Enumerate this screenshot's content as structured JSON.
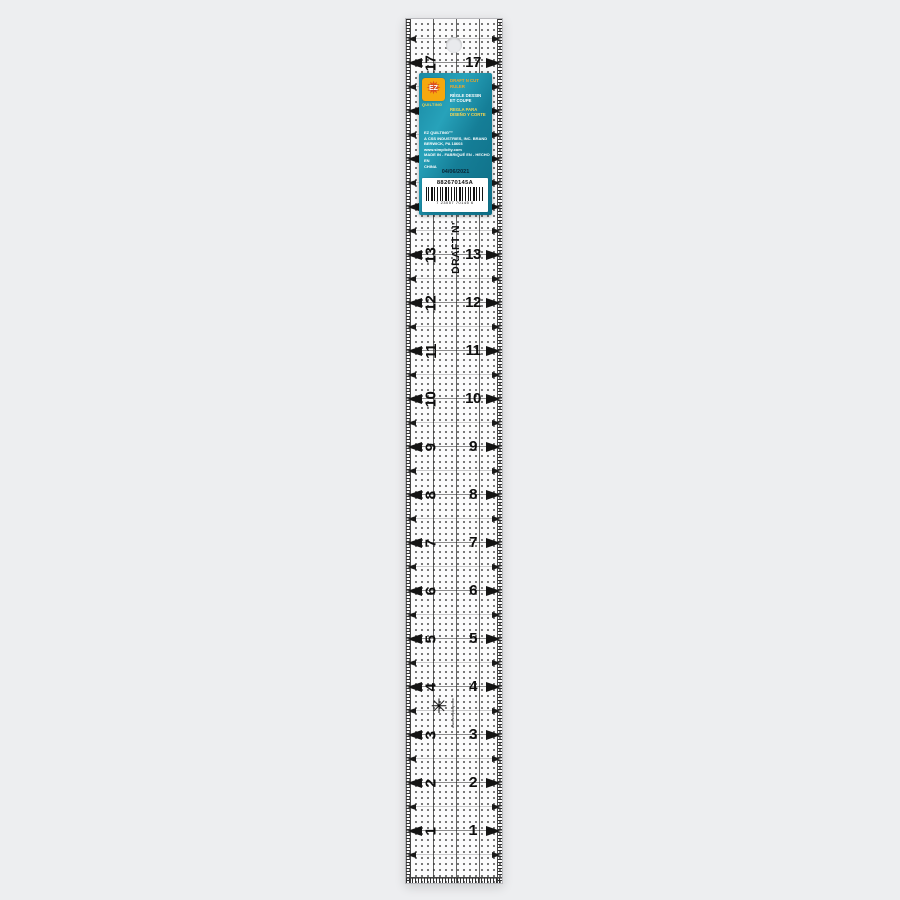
{
  "page": {
    "background_color": "#edeef0"
  },
  "ruler": {
    "inch_numbers": [
      "17",
      "16",
      "15",
      "14",
      "13",
      "12",
      "11",
      "10",
      "9",
      "8",
      "7",
      "6",
      "5",
      "4",
      "3",
      "2",
      "1"
    ],
    "brand_text": "DRAFT N'",
    "center_star_icon": "✳",
    "website_vertical_text": "www.simplicity.com",
    "mark_color": "#141414"
  },
  "tag": {
    "logo_star_icon": "✹",
    "logo_monogram": "EZ",
    "brand_name": "QUILTING",
    "title_en": "DRAFT N CUT RULER",
    "title_fr_line1": "RÈGLE DESSIN",
    "title_fr_line2": "ET COUPE",
    "title_es_line1": "REGLA PARA",
    "title_es_line2": "DISEÑO Y CORTE",
    "company_line1": "EZ QUILTING™",
    "company_line2": "A CSS INDUSTRIES, INC. BRAND",
    "company_line3": "BERWICK, PA 18603",
    "company_line4": "www.simplicity.com",
    "company_line5": "MADE IN - FABRIQUÉ EN - HECHO EN",
    "company_line6": "CHINA",
    "date": "04/06/2021",
    "sku": "882670145A",
    "barcode_digits": "7 23057 70145 6",
    "colors": {
      "teal": "#1a89a3",
      "teal_dark": "#0e6e86",
      "logo_yellow": "#f6a80e",
      "title_orange": "#f5a623",
      "title_yellow": "#ffd84d"
    }
  },
  "layout_constants": {
    "inch_spacing_px": 48,
    "first_inch_y_px": 44,
    "first_half_inch_y_px": 20,
    "half_inch_count": 18
  }
}
